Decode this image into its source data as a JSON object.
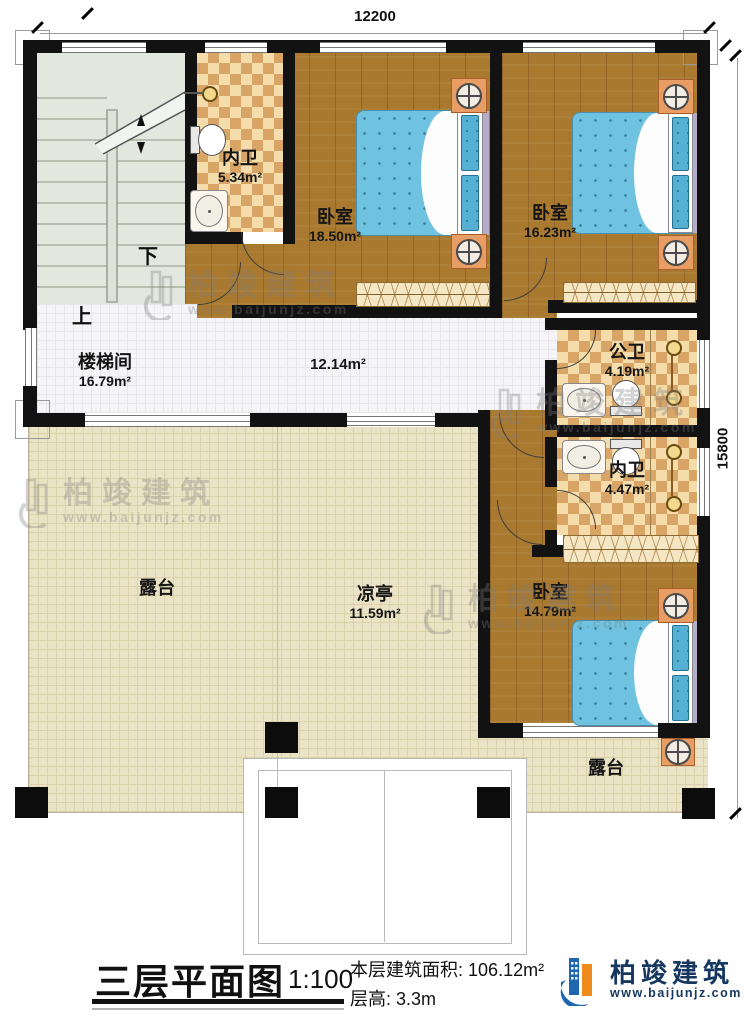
{
  "dimensions": {
    "top": "12200",
    "right": "15800"
  },
  "rooms": {
    "neiwei1": {
      "name": "内卫",
      "area": "5.34m²"
    },
    "bedroom1": {
      "name": "卧室",
      "area": "18.50m²"
    },
    "bedroom2": {
      "name": "卧室",
      "area": "16.23m²"
    },
    "stairwell": {
      "name": "楼梯间",
      "area": "16.79m²"
    },
    "hallway": {
      "area": "12.14m²"
    },
    "gongwei": {
      "name": "公卫",
      "area": "4.19m²"
    },
    "neiwei2": {
      "name": "内卫",
      "area": "4.47m²"
    },
    "bedroom3": {
      "name": "卧室",
      "area": "14.79m²"
    },
    "terrace_left": {
      "name": "露台"
    },
    "pavilion": {
      "name": "凉亭",
      "area": "11.59m²"
    },
    "terrace_bottom": {
      "name": "露台"
    }
  },
  "stairs": {
    "down": "下",
    "up": "上"
  },
  "watermark": {
    "brand": "柏竣建筑",
    "url": "www.baijunjz.com"
  },
  "footer": {
    "title": "三层平面图",
    "scale": "1:100",
    "area_label": "本层建筑面积:",
    "area_value": "106.12m²",
    "height_label": "层高:",
    "height_value": "3.3m",
    "brand": "柏竣建筑",
    "brand_url": "www.baijunjz.com"
  },
  "colors": {
    "accent_blue": "#1e67b0",
    "accent_orange": "#ef8b1d",
    "wall": "#121212"
  }
}
